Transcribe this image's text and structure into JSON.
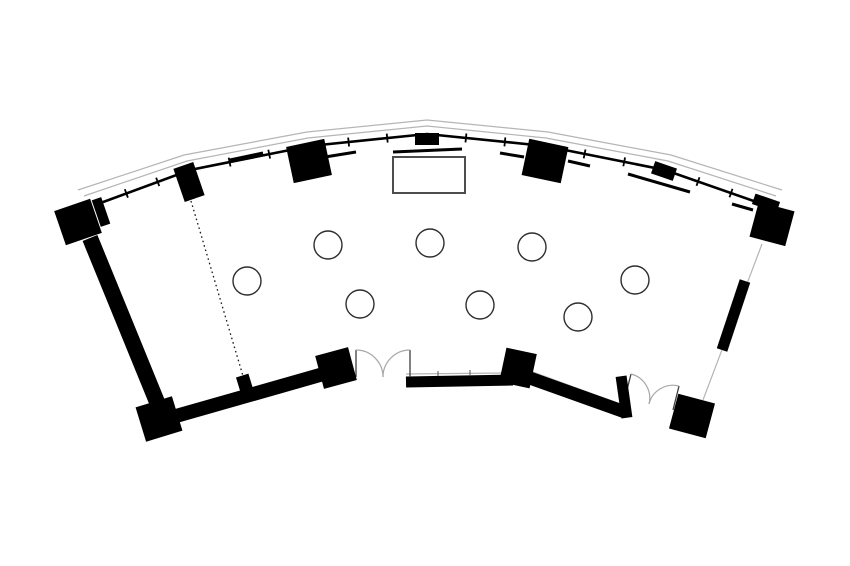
{
  "document": {
    "title": "Fan-shaped banquet room floor plan",
    "visible_text": []
  },
  "colors": {
    "background": "#ffffff",
    "wall": "#000000",
    "glass": "#b5b5b5",
    "door_arc": "#a8a8a8",
    "door_leaf": "#3d3d3d",
    "stage_stroke": "#4d4d4d",
    "table_stroke": "#2e2e2e",
    "partition": "#1a1a1a",
    "sill_tick": "#555555"
  },
  "floorplan": {
    "canvas": {
      "width": 850,
      "height": 566
    },
    "facade": {
      "glass_outer": [
        [
          78,
          190
        ],
        [
          184,
          155
        ],
        [
          307,
          132
        ],
        [
          427,
          120
        ],
        [
          548,
          132
        ],
        [
          671,
          155
        ],
        [
          782,
          190
        ]
      ],
      "glass_inner": [
        [
          84,
          196
        ],
        [
          187,
          161
        ],
        [
          308,
          138
        ],
        [
          427,
          126
        ],
        [
          546,
          138
        ],
        [
          668,
          161
        ],
        [
          776,
          196
        ]
      ],
      "mullion": [
        [
          95,
          205
        ],
        [
          190,
          170
        ],
        [
          310,
          146
        ],
        [
          427,
          134
        ],
        [
          545,
          146
        ],
        [
          665,
          170
        ],
        [
          765,
          205
        ]
      ],
      "tick_fractions": [
        0.33,
        0.66
      ],
      "tick_len": 9
    },
    "sill_segments": [
      [
        230,
        160,
        263,
        153
      ],
      [
        325,
        157,
        356,
        152
      ],
      [
        393,
        152,
        462,
        149
      ],
      [
        500,
        153,
        524,
        157
      ],
      [
        568,
        161,
        590,
        166
      ],
      [
        628,
        174,
        690,
        192
      ],
      [
        732,
        204,
        753,
        210
      ]
    ],
    "thin_lines": [
      {
        "id": "sill-line-bottom-center",
        "pts": [
          [
            406,
            374
          ],
          [
            505,
            373
          ]
        ]
      },
      {
        "id": "sill-line-bottom-right",
        "pts": [
          [
            530,
            371
          ],
          [
            623,
            405
          ]
        ]
      },
      {
        "id": "glass-line-right-wall",
        "pts": [
          [
            762,
            244
          ],
          [
            703,
            400
          ]
        ]
      }
    ],
    "small_ticks": [
      [
        438,
        371,
        438,
        376
      ],
      [
        470,
        370,
        470,
        375
      ]
    ],
    "walls": [
      {
        "id": "wall-left",
        "x1": 90,
        "y1": 238,
        "x2": 157,
        "y2": 402,
        "w": 16
      },
      {
        "id": "wall-bottom-left",
        "x1": 155,
        "y1": 422,
        "x2": 341,
        "y2": 369,
        "w": 14
      },
      {
        "id": "wall-bottom-center",
        "x1": 406,
        "y1": 382,
        "x2": 513,
        "y2": 380,
        "w": 11
      },
      {
        "id": "wall-bottom-right",
        "x1": 527,
        "y1": 377,
        "x2": 625,
        "y2": 412,
        "w": 13
      },
      {
        "id": "wall-right",
        "x1": 745,
        "y1": 281,
        "x2": 722,
        "y2": 350,
        "w": 11
      }
    ],
    "columns": [
      {
        "id": "col-top-left-main",
        "cx": 78,
        "cy": 222,
        "w": 38,
        "h": 36,
        "rot": -19
      },
      {
        "id": "col-top-left-arm",
        "cx": 101,
        "cy": 212,
        "w": 10,
        "h": 28,
        "rot": -19
      },
      {
        "id": "col-window-1",
        "cx": 189,
        "cy": 182,
        "w": 21,
        "h": 35,
        "rot": -19
      },
      {
        "id": "col-window-2",
        "cx": 309,
        "cy": 161,
        "w": 39,
        "h": 37,
        "rot": -12
      },
      {
        "id": "col-window-apex",
        "cx": 427,
        "cy": 139,
        "w": 24,
        "h": 12,
        "rot": 0
      },
      {
        "id": "col-window-3",
        "cx": 545,
        "cy": 161,
        "w": 40,
        "h": 37,
        "rot": 12
      },
      {
        "id": "col-window-4",
        "cx": 664,
        "cy": 171,
        "w": 23,
        "h": 13,
        "rot": 19
      },
      {
        "id": "col-top-right-arm",
        "cx": 766,
        "cy": 203,
        "w": 26,
        "h": 11,
        "rot": 19
      },
      {
        "id": "col-top-right-main",
        "cx": 772,
        "cy": 224,
        "w": 37,
        "h": 36,
        "rot": 15
      },
      {
        "id": "col-bottom-left",
        "cx": 159,
        "cy": 419,
        "w": 38,
        "h": 36,
        "rot": -17
      },
      {
        "id": "pier-partition-end",
        "cx": 246,
        "cy": 388,
        "w": 13,
        "h": 26,
        "rot": -17
      },
      {
        "id": "col-door1-left",
        "cx": 336,
        "cy": 368,
        "w": 34,
        "h": 34,
        "rot": -15
      },
      {
        "id": "col-door1-right",
        "cx": 518,
        "cy": 368,
        "w": 31,
        "h": 35,
        "rot": 12
      },
      {
        "id": "post-door2-left",
        "cx": 624,
        "cy": 397,
        "w": 11,
        "h": 42,
        "rot": -8
      },
      {
        "id": "col-bottom-right",
        "cx": 692,
        "cy": 416,
        "w": 38,
        "h": 36,
        "rot": 15
      }
    ],
    "partition_dashed": {
      "x1": 191,
      "y1": 201,
      "x2": 243,
      "y2": 376
    },
    "stage": {
      "x": 393,
      "y": 157,
      "w": 72,
      "h": 36
    },
    "tables": {
      "radius": 14,
      "positions": [
        [
          247,
          281
        ],
        [
          328,
          245
        ],
        [
          430,
          243
        ],
        [
          532,
          247
        ],
        [
          635,
          280
        ],
        [
          360,
          304
        ],
        [
          480,
          305
        ],
        [
          578,
          317
        ]
      ]
    },
    "doors": [
      {
        "id": "door-main-entry",
        "hinges": [
          [
            356,
            377
          ],
          [
            410,
            377
          ]
        ]
      },
      {
        "id": "door-side-entry",
        "hinges": [
          [
            625,
            398
          ],
          [
            673,
            410
          ]
        ]
      }
    ]
  }
}
